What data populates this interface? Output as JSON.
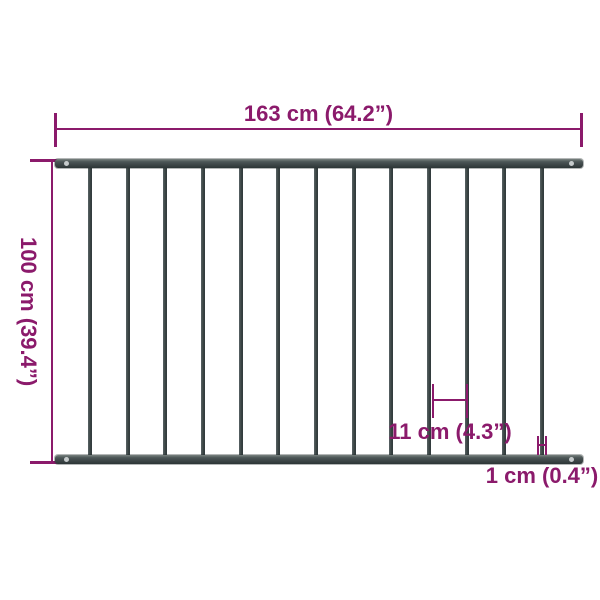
{
  "image": {
    "subject": "fence-panel-dimension-diagram"
  },
  "labels": {
    "width": "163 cm (64.2”)",
    "height": "100 cm (39.4”)",
    "gap": "11 cm (4.3”)",
    "bar_thickness": "1 cm (0.4”)"
  },
  "colors": {
    "background": "#ffffff",
    "dimension": "#8b1a6b",
    "rail_dark": "#3a4344",
    "rail_light": "#79827f",
    "screw": "#c6cbcc"
  },
  "fence": {
    "bars": 13
  }
}
